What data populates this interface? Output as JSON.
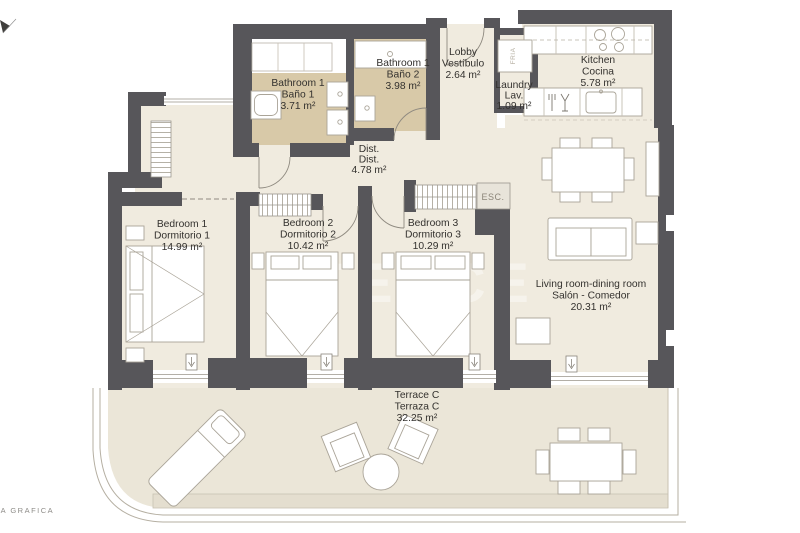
{
  "plan": {
    "credit": "LA GRAFICA",
    "watermark": "TEKCE",
    "rooms": {
      "bathroom1": {
        "name_en": "Bathroom 1",
        "name_es": "Baño 1",
        "area": "3.71 m²"
      },
      "bathroom2": {
        "name_en": "Bathroom 1",
        "name_es": "Baño 2",
        "area": "3.98 m²"
      },
      "lobby": {
        "name_en": "Lobby",
        "name_es": "Vestíbulo",
        "area": "2.64 m²"
      },
      "kitchen": {
        "name_en": "Kitchen",
        "name_es": "Cocina",
        "area": "5.78 m²"
      },
      "laundry": {
        "name_en": "Laundry",
        "name_es": "Lav.",
        "area": "1.09 m²"
      },
      "dist": {
        "name_en": "Dist.",
        "name_es": "Dist.",
        "area": "4.78 m²"
      },
      "bedroom1": {
        "name_en": "Bedroom 1",
        "name_es": "Dormitorio 1",
        "area": "14.99 m²"
      },
      "bedroom2": {
        "name_en": "Bedroom 2",
        "name_es": "Dormitorio 2",
        "area": "10.42 m²"
      },
      "bedroom3": {
        "name_en": "Bedroom 3",
        "name_es": "Dormitorio 3",
        "area": "10.29 m²"
      },
      "living": {
        "name_en": "Living room-dining room",
        "name_es": "Salón - Comedor",
        "area": "20.31 m²"
      },
      "terrace": {
        "name_en": "Terrace C",
        "name_es": "Terraza C",
        "area": "32.25 m²"
      }
    },
    "labels": {
      "stairs": "ESC.",
      "fridge": "FRIA"
    },
    "colors": {
      "wall": "#57565a",
      "floor": "#f0ebdf",
      "bathroom": "#d8c9a8",
      "terrace": "#ebe6d8"
    }
  }
}
